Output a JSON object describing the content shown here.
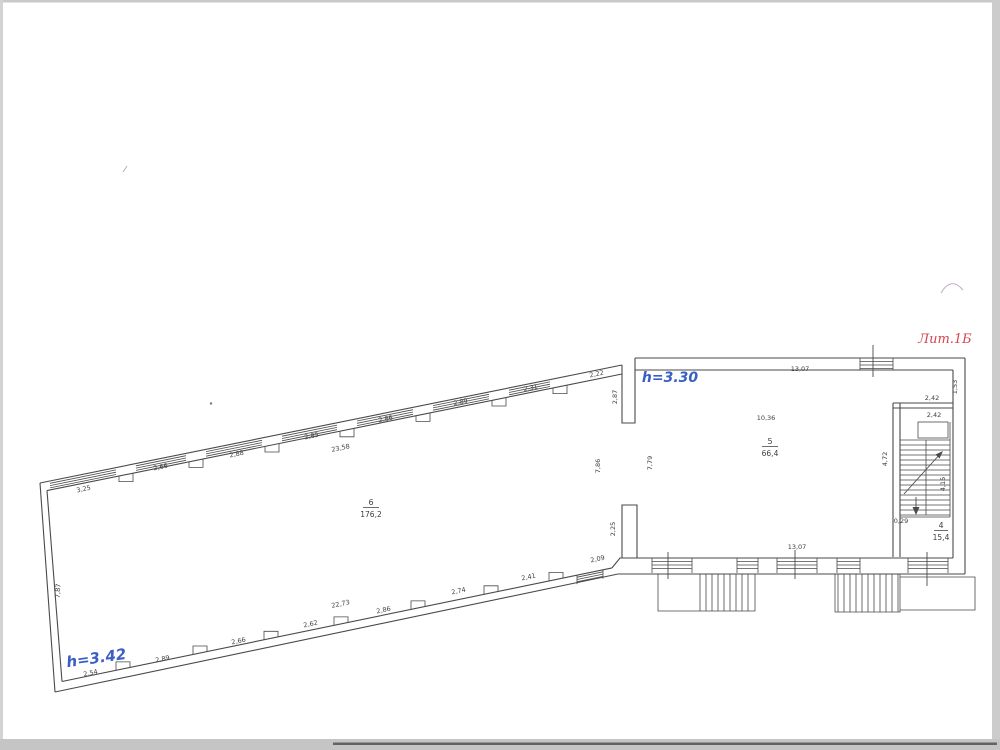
{
  "annotations": {
    "liter": "Лит.1Б",
    "height_left": "h=3.42",
    "height_right": "h=3.30"
  },
  "colors": {
    "line": "#4a4a4a",
    "height_blue": "#3a5fc4",
    "liter_red": "#d4454f"
  },
  "rooms": [
    {
      "number": "6",
      "area": "176,2"
    },
    {
      "number": "5",
      "area": "66,4"
    },
    {
      "number": "4",
      "area": "15,4"
    }
  ],
  "dims": {
    "top": [
      "3,25",
      "2,66",
      "2,88",
      "2,85",
      "2,86",
      "2,89",
      "2,31",
      "2,22"
    ],
    "top_overall": "23,58",
    "top_stub": "2,87",
    "bottom": [
      "2,54",
      "2,89",
      "2,66",
      "2,62",
      "2,86",
      "2,74",
      "2,41",
      "2,09"
    ],
    "bottom_overall": "22,73",
    "left_wall": "7,87",
    "right_section_top": "13,07",
    "right_section_mid": "10,36",
    "right_section_bottom": "13,07",
    "stair_above": "2,42",
    "stair_below": "2,42",
    "right_strip": "1,53",
    "stair_left": "4,72",
    "stair_right": "4,15",
    "stair_offset": "0,29",
    "opening_left": "7,86",
    "opening_right": "7,79",
    "stub_bottom": "2,25"
  }
}
